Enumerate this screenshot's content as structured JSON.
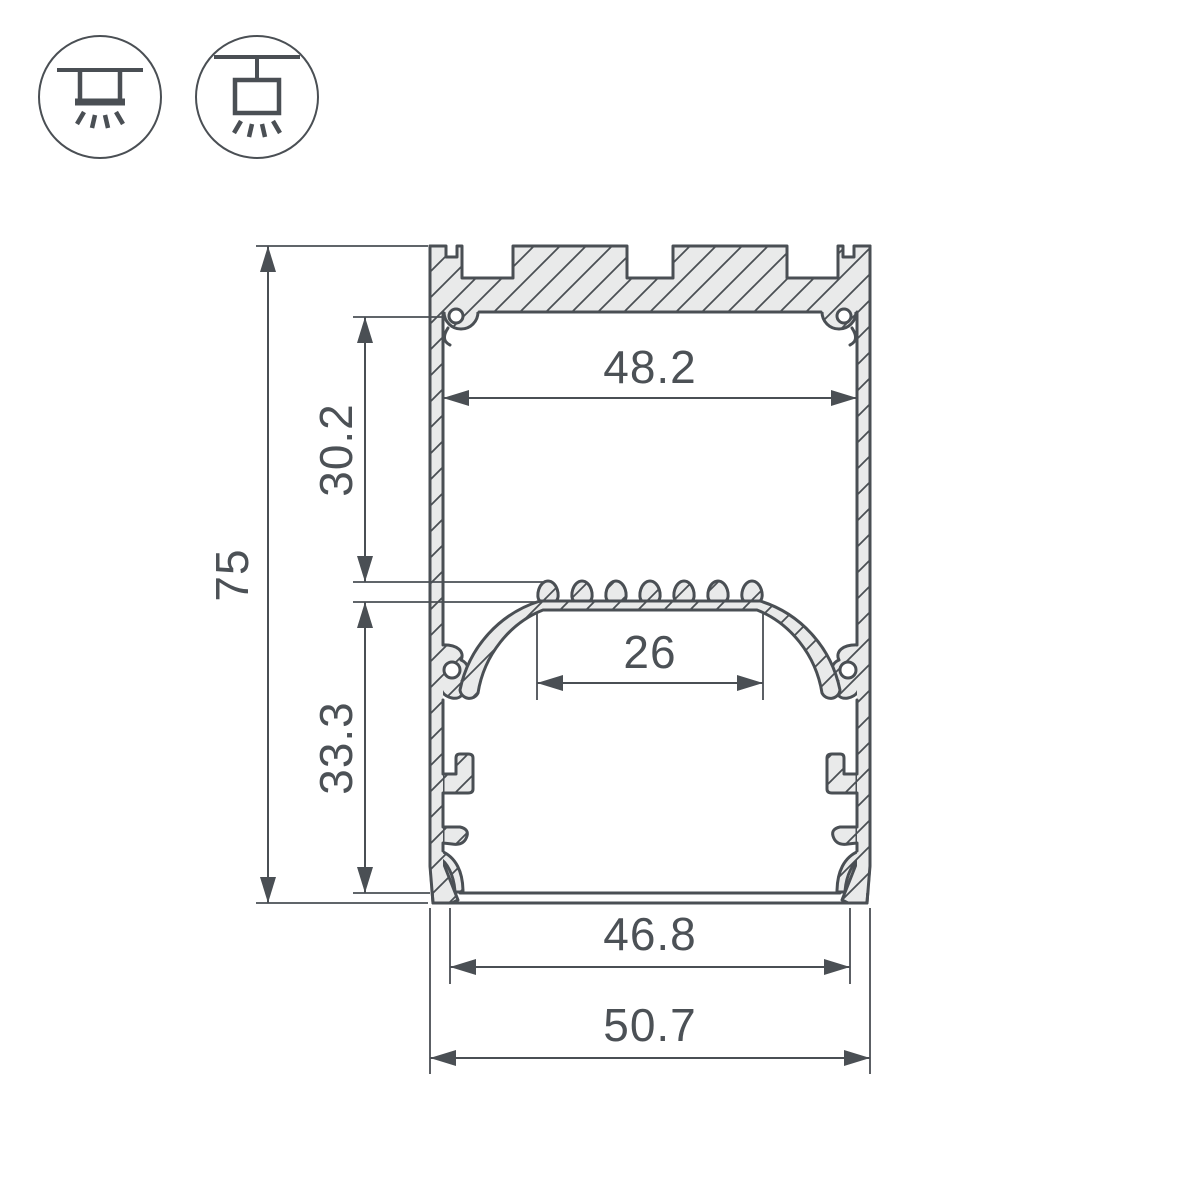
{
  "drawing": {
    "type": "led-profile-cross-section",
    "dimensions": {
      "overall_height": "75",
      "upper_cavity_height": "30.2",
      "lower_cavity_height": "33.3",
      "upper_cavity_width": "48.2",
      "led_platform_width": "26",
      "bottom_opening_width": "46.8",
      "overall_width": "50.7"
    },
    "icons": {
      "surface_mount": "ceiling-surface-mount",
      "pendant_mount": "suspended-pendant-mount"
    },
    "colors": {
      "line": "#4a4f54",
      "material_fill": "#e9eaea",
      "background": "#ffffff",
      "text": "#4c5156"
    }
  }
}
